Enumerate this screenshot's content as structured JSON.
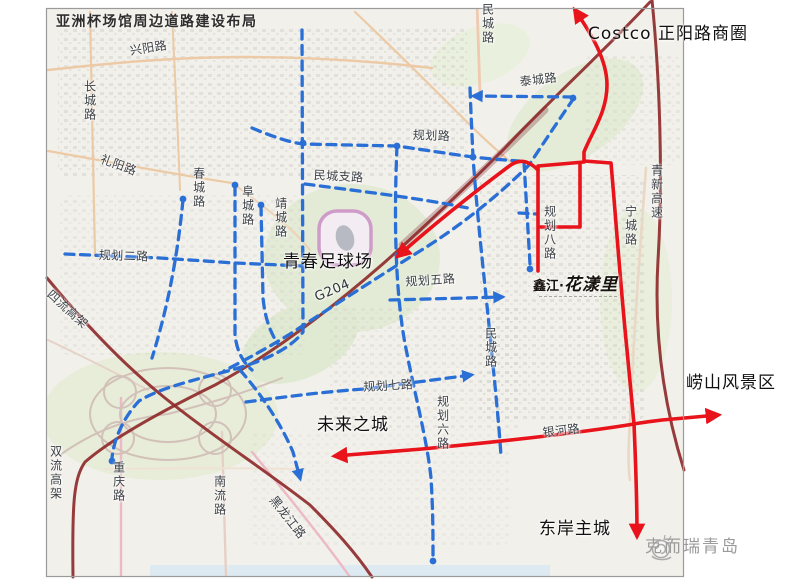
{
  "title": "亚洲杯场馆周边道路建设布局",
  "watermark": "克而瑞青岛",
  "landmark": {
    "prefix": "鑫江",
    "separator": "·",
    "name": "花漾里"
  },
  "colors": {
    "planned_road_blue": "#2a6fd6",
    "key_route_red": "#e8131b",
    "expressway_maroon": "#8e2b2b",
    "map_background": "#f2f0ea",
    "frame_gray": "#9a9a9a",
    "watermark_gray": "#9b9b9b"
  },
  "labels": [
    {
      "name": "label-xingyang-road",
      "text": "兴阳路",
      "x": 129,
      "y": 45,
      "rot": -9,
      "size": 12
    },
    {
      "name": "label-changcheng-road",
      "text": "长城路",
      "x": 83,
      "y": 80,
      "v": true,
      "size": 12
    },
    {
      "name": "label-liyang-road",
      "text": "礼阳路",
      "x": 103,
      "y": 153,
      "rot": 20,
      "size": 12
    },
    {
      "name": "label-chuncheng-road",
      "text": "春城路",
      "x": 192,
      "y": 167,
      "v": true,
      "size": 12
    },
    {
      "name": "label-fucheng-road",
      "text": "阜城路",
      "x": 241,
      "y": 185,
      "v": true,
      "size": 12
    },
    {
      "name": "label-jingcheng-road",
      "text": "靖城路",
      "x": 274,
      "y": 197,
      "v": true,
      "size": 12
    },
    {
      "name": "label-mincheng-branch-road",
      "text": "民城支路",
      "x": 314,
      "y": 169,
      "rot": 3,
      "size": 12
    },
    {
      "name": "label-guihua-road",
      "text": "规划路",
      "x": 413,
      "y": 129,
      "rot": 2,
      "size": 12
    },
    {
      "name": "label-taicheng-road",
      "text": "泰城路",
      "x": 519,
      "y": 76,
      "rot": -7,
      "size": 12
    },
    {
      "name": "label-mincheng-road-north",
      "text": "民城路",
      "x": 481,
      "y": 3,
      "v": true,
      "size": 12
    },
    {
      "name": "label-guihua-2-road",
      "text": "规划二路",
      "x": 99,
      "y": 249,
      "rot": 2,
      "size": 12
    },
    {
      "name": "label-g204-highway",
      "text": "G204",
      "x": 313,
      "y": 292,
      "rot": -23,
      "size": 13,
      "color": "#2e3338"
    },
    {
      "name": "label-guihua-5-road",
      "text": "规划五路",
      "x": 405,
      "y": 276,
      "rot": -4,
      "size": 12
    },
    {
      "name": "label-mincheng-road-mid",
      "text": "民城路",
      "x": 484,
      "y": 327,
      "v": true,
      "size": 12
    },
    {
      "name": "label-guihua-8-road",
      "text": "规划八路",
      "x": 543,
      "y": 205,
      "v": true,
      "size": 12
    },
    {
      "name": "label-ningcheng-road",
      "text": "宁城路",
      "x": 624,
      "y": 205,
      "v": true,
      "size": 12
    },
    {
      "name": "label-qingxin-expressway",
      "text": "青新高速",
      "x": 650,
      "y": 164,
      "v": true,
      "size": 12
    },
    {
      "name": "label-guihua-7-road",
      "text": "规划七路",
      "x": 363,
      "y": 381,
      "rot": -3,
      "size": 12
    },
    {
      "name": "label-guihua-6-road",
      "text": "规划六路",
      "x": 436,
      "y": 395,
      "v": true,
      "size": 12
    },
    {
      "name": "label-yinhe-road",
      "text": "银河路",
      "x": 542,
      "y": 427,
      "rot": -7,
      "size": 12
    },
    {
      "name": "label-siliu-viaduct",
      "text": "四流高架",
      "x": 53,
      "y": 288,
      "rot": 42,
      "size": 12
    },
    {
      "name": "label-shuangliu-viaduct",
      "text": "双流高架",
      "x": 49,
      "y": 445,
      "v": true,
      "size": 12
    },
    {
      "name": "label-chongqing-road",
      "text": "重庆路",
      "x": 112,
      "y": 461,
      "v": true,
      "size": 12
    },
    {
      "name": "label-nanliu-road",
      "text": "南流路",
      "x": 213,
      "y": 475,
      "v": true,
      "size": 12
    },
    {
      "name": "label-heilongjiang-road",
      "text": "黑龙江路",
      "x": 277,
      "y": 494,
      "rot": 52,
      "size": 12
    },
    {
      "name": "annotation-costco-zhengyang",
      "text": "Costco 正阳路商圈",
      "x": 588,
      "y": 26,
      "size": 17,
      "ann": true
    },
    {
      "name": "annotation-youth-football-stadium",
      "text": "青春足球场",
      "x": 283,
      "y": 254,
      "size": 17,
      "ann": true
    },
    {
      "name": "annotation-future-city",
      "text": "未来之城",
      "x": 317,
      "y": 417,
      "size": 17,
      "ann": true
    },
    {
      "name": "annotation-laoshan-scenic-area",
      "text": "崂山风景区",
      "x": 686,
      "y": 375,
      "size": 17,
      "ann": true
    },
    {
      "name": "annotation-east-coast-main-city",
      "text": "东岸主城",
      "x": 539,
      "y": 521,
      "size": 17,
      "ann": true
    }
  ]
}
